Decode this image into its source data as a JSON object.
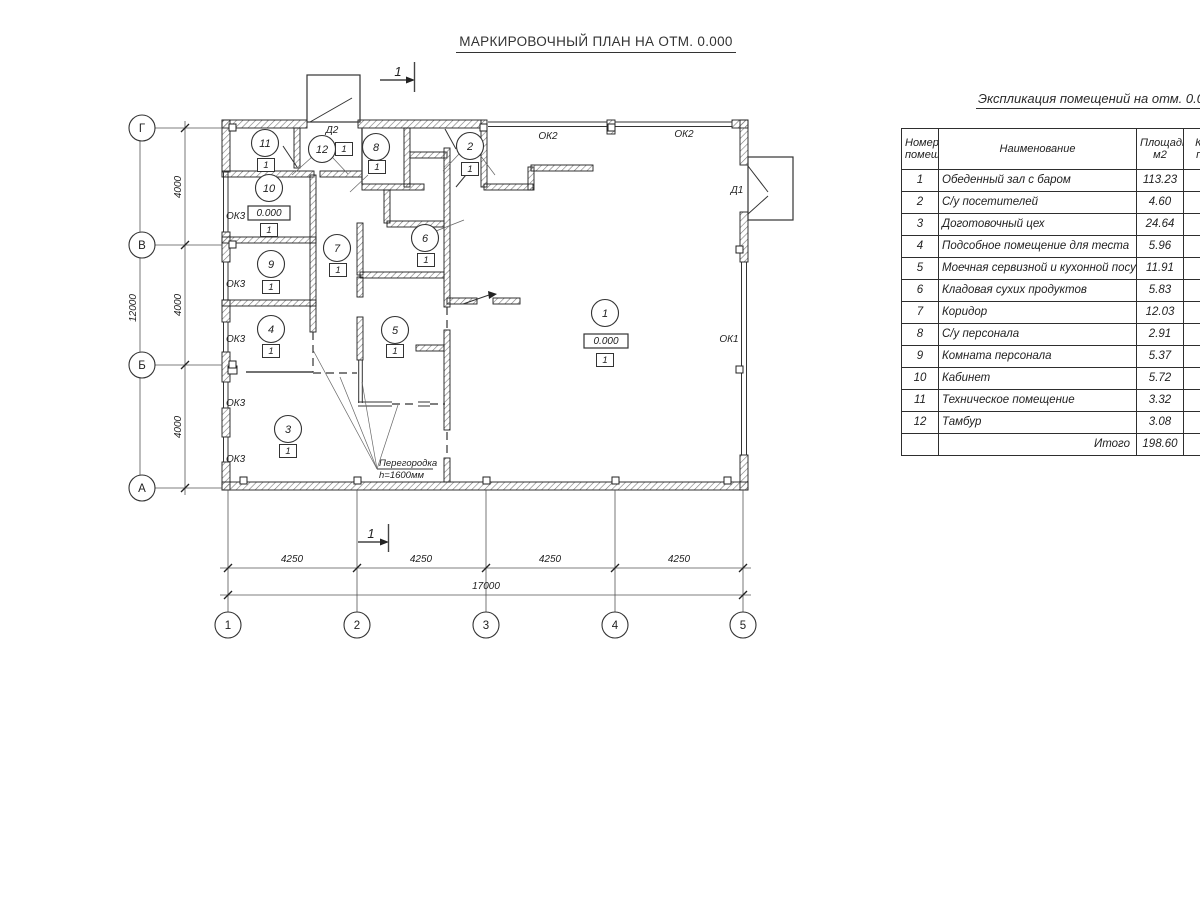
{
  "title": "МАРКИРОВОЧНЫЙ ПЛАН НА ОТМ. 0.000",
  "plan": {
    "section_label": "1",
    "grid_rows": [
      "Г",
      "В",
      "Б",
      "А"
    ],
    "grid_cols": [
      "1",
      "2",
      "3",
      "4",
      "5"
    ],
    "room_numbers": [
      "11",
      "12",
      "8",
      "2",
      "10",
      "7",
      "6",
      "9",
      "4",
      "5",
      "3",
      "1"
    ],
    "floor_type": "1",
    "elevation_mark": "0.000",
    "window_labels": {
      "ok1": "ОК1",
      "ok2": "ОК2",
      "ok3": "ОК3"
    },
    "door_labels": {
      "d1": "Д1",
      "d2": "Д2"
    },
    "partition_note": {
      "line1": "Перегородка",
      "line2": "h=1600мм"
    },
    "dimensions": {
      "left_total": "12000",
      "left_segments": [
        "4000",
        "4000",
        "4000"
      ],
      "bottom_segments": [
        "4250",
        "4250",
        "4250",
        "4250"
      ],
      "bottom_total": "17000"
    }
  },
  "table": {
    "title": "Экспликация помещений на отм. 0.000",
    "headers": {
      "num": "Номер\nпомещ.",
      "name": "Наименование",
      "area": "Площадь,\nм2",
      "cat": "Кат.\nпом."
    },
    "rows": [
      {
        "num": "1",
        "name": "Обеденный зал с баром",
        "area": "113.23"
      },
      {
        "num": "2",
        "name": "С/у посетителей",
        "area": "4.60"
      },
      {
        "num": "3",
        "name": "Доготовочный цех",
        "area": "24.64"
      },
      {
        "num": "4",
        "name": "Подсобное помещение для теста",
        "area": "5.96"
      },
      {
        "num": "5",
        "name": "Моечная сервизной и кухонной посуды",
        "area": "11.91"
      },
      {
        "num": "6",
        "name": "Кладовая сухих продуктов",
        "area": "5.83"
      },
      {
        "num": "7",
        "name": "Коридор",
        "area": "12.03"
      },
      {
        "num": "8",
        "name": "С/у персонала",
        "area": "2.91"
      },
      {
        "num": "9",
        "name": "Комната персонала",
        "area": "5.37"
      },
      {
        "num": "10",
        "name": "Кабинет",
        "area": "5.72"
      },
      {
        "num": "11",
        "name": "Техническое помещение",
        "area": "3.32"
      },
      {
        "num": "12",
        "name": "Тамбур",
        "area": "3.08"
      }
    ],
    "total_label": "Итого",
    "total_value": "198.60"
  }
}
